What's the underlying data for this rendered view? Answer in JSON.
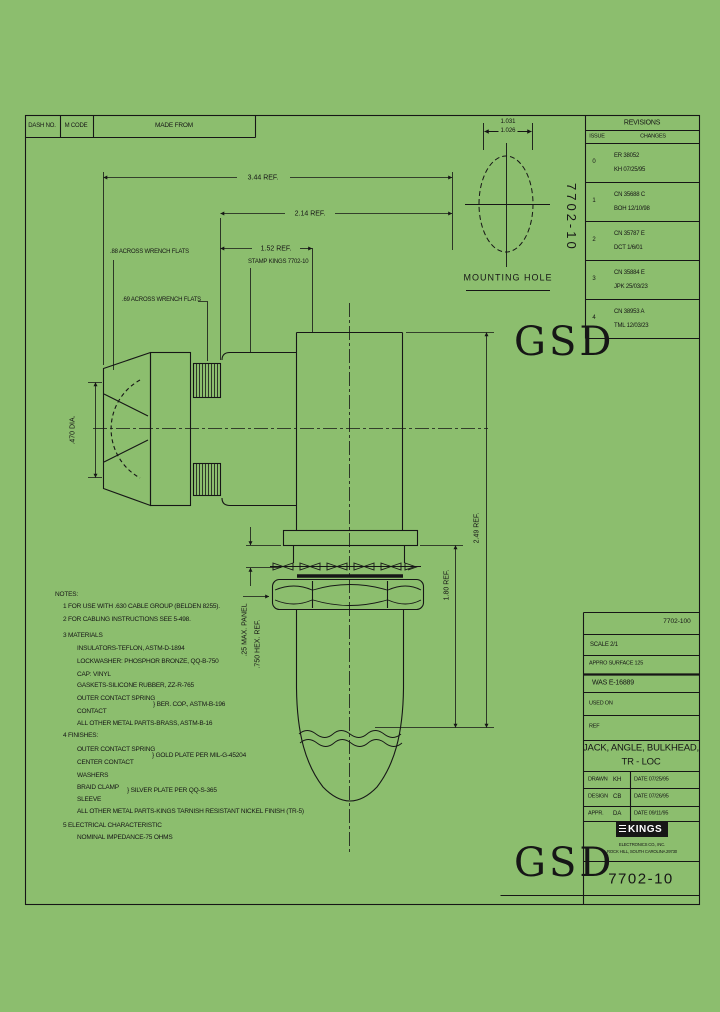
{
  "colors": {
    "paper": "#8cbe6e",
    "ink": "#161616",
    "logo_text": "#ffffff"
  },
  "header_table": {
    "dash_no": "DASH NO.",
    "m_code": "M CODE",
    "made_from": "MADE FROM"
  },
  "revisions": {
    "title": "REVISIONS",
    "col_issue": "ISSUE",
    "col_changes": "CHANGES",
    "rows": [
      {
        "issue": "0",
        "ref": "ER 38052",
        "sign": "KH 07/25/95"
      },
      {
        "issue": "1",
        "ref": "CN 35688 C",
        "sign": "BOH 12/10/98"
      },
      {
        "issue": "2",
        "ref": "CN 35787 E",
        "sign": "DCT 1/6/01"
      },
      {
        "issue": "3",
        "ref": "CN 35884 E",
        "sign": "JPK 25/03/23"
      },
      {
        "issue": "4",
        "ref": "CN 38953 A",
        "sign": "TML 12/03/23"
      }
    ]
  },
  "side_label": "7702-10",
  "watermark": "GSD",
  "mounting_hole": {
    "dim_upper": "1.031",
    "dim_lower": "1.026",
    "label": "MOUNTING HOLE"
  },
  "dimensions": {
    "overall": "3.44 REF.",
    "mid": "2.14 REF.",
    "short": "1.52 REF.",
    "stamp_note": "STAMP KINGS 7702-10",
    "flats_large": ".88 ACROSS WRENCH FLATS",
    "flats_small": ".69 ACROSS WRENCH FLATS",
    "nose_dia": ".470 DIA.",
    "height_overall": "2.49 REF.",
    "height_lower": "1.80 REF.",
    "panel": ".25 MAX. PANEL",
    "hex": ".750 HEX. REF."
  },
  "notes": {
    "title": "NOTES:",
    "n1": "1   FOR USE WITH .630 CABLE GROUP (BELDEN 8255).",
    "n2": "2   FOR CABLING INSTRUCTIONS SEE 5-498.",
    "n3": "3   MATERIALS",
    "m1": "INSULATORS-TEFLON, ASTM-D-1894",
    "m2": "LOCKWASHER: PHOSPHOR BRONZE, QQ-B-750",
    "m3": "CAP: VINYL",
    "m4": "GASKETS-SILICONE RUBBER, ZZ-R-765",
    "m5": "OUTER CONTACT SPRING",
    "m5b": "} BER. COP., ASTM-B-196",
    "m6": "CONTACT",
    "m7": "ALL OTHER METAL PARTS-BRASS, ASTM-B-16",
    "n4": "4   FINISHES:",
    "f1": "OUTER CONTACT SPRING",
    "f1b": "} GOLD PLATE PER MIL-G-45204",
    "f2": "CENTER CONTACT",
    "f3": "WASHERS",
    "f4": "BRAID CLAMP",
    "f4b": "} SILVER PLATE PER QQ-S-365",
    "f5": "SLEEVE",
    "f6": "ALL OTHER METAL PARTS-KINGS TARNISH RESISTANT NICKEL FINISH (TR-5)",
    "n5": "5   ELECTRICAL CHARACTERISTIC",
    "e1": "NOMINAL IMPEDANCE-75 OHMS"
  },
  "title_block": {
    "doc_no": "7702-100",
    "scale": "SCALE 2/1",
    "surface": "APPRO SURFACE 125",
    "was": "WAS E-16889",
    "used_on": "USED ON",
    "ref": "REF",
    "title_line1": "JACK, ANGLE, BULKHEAD,",
    "title_line2": "TR - LOC",
    "drawn_label": "DRAWN",
    "drawn_by": "KH",
    "drawn_date": "DATE 07/25/95",
    "design_label": "DESIGN",
    "design_by": "CB",
    "design_date": "DATE 07/26/95",
    "appr_label": "APPR.",
    "appr_by": "DA",
    "appr_date": "DATE 09/11/95",
    "company_logo": "KINGS",
    "company_line1": "ELECTRONICS CO., INC.",
    "company_line2": "ROCK HILL, SOUTH CAROLINA 29730",
    "part_no": "7702-10"
  }
}
